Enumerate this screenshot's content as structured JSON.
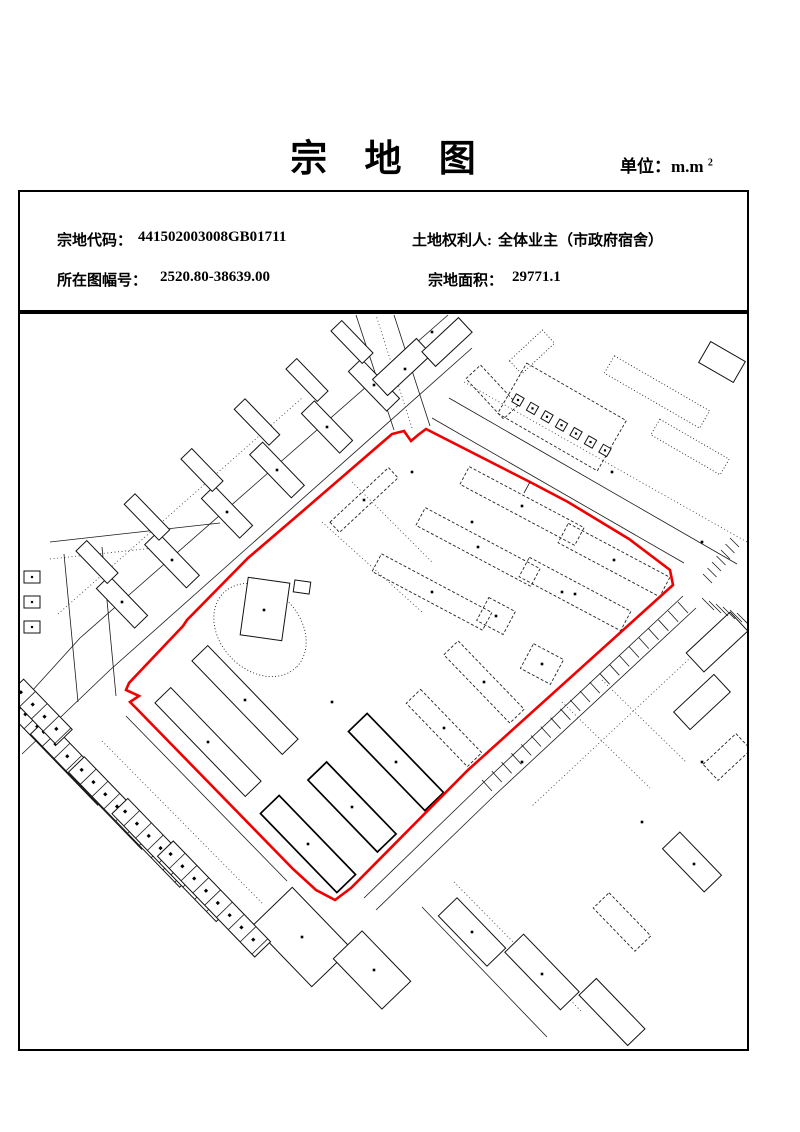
{
  "page": {
    "title": "宗 地 图",
    "unit_label": "单位：m.m",
    "unit_sup": "2"
  },
  "info": {
    "parcel_code_label": "宗地代码：",
    "parcel_code": "441502003008GB01711",
    "sheet_label": "所在图幅号：",
    "sheet_no": "2520.80-38639.00",
    "owner_label": "土地权利人: ",
    "owner": "全体业主（市政府宿舍）",
    "area_label": "宗地面积：",
    "area": "29771.1"
  },
  "map": {
    "north_label": "北",
    "boundary_color": "#f00000",
    "point_label_color": "#ff0000",
    "building_number_color": "#0008ff",
    "boundary_points": [
      {
        "name": "J1",
        "x": 409,
        "y": 439,
        "lx": 411,
        "ly": 451
      },
      {
        "name": "J2",
        "x": 416,
        "y": 433,
        "lx": 422,
        "ly": 439
      },
      {
        "name": "J3",
        "x": 424,
        "y": 427,
        "lx": 430,
        "ly": 422
      },
      {
        "name": "J4",
        "x": 528,
        "y": 480,
        "lx": 532,
        "ly": 473
      },
      {
        "name": "J5",
        "x": 566,
        "y": 500,
        "lx": 567,
        "ly": 493
      },
      {
        "name": "J6",
        "x": 627,
        "y": 537,
        "lx": 627,
        "ly": 530
      },
      {
        "name": "J7",
        "x": 668,
        "y": 568,
        "lx": 679,
        "ly": 566
      },
      {
        "name": "J8",
        "x": 671,
        "y": 583,
        "lx": 682,
        "ly": 586
      },
      {
        "name": "J9",
        "x": 466,
        "y": 768,
        "lx": 476,
        "ly": 779
      },
      {
        "name": "J10",
        "x": 349,
        "y": 886,
        "lx": 360,
        "ly": 886
      },
      {
        "name": "J11",
        "x": 333,
        "y": 898,
        "lx": 340,
        "ly": 909
      },
      {
        "name": "J12",
        "x": 314,
        "y": 888,
        "lx": 310,
        "ly": 898
      },
      {
        "name": "J13",
        "x": 291,
        "y": 867,
        "lx": 278,
        "ly": 864
      },
      {
        "name": "J14",
        "x": 134,
        "y": 706,
        "lx": 127,
        "ly": 719
      },
      {
        "name": "J15",
        "x": 128,
        "y": 700,
        "lx": 116,
        "ly": 706
      },
      {
        "name": "J16",
        "x": 137,
        "y": 694,
        "lx": 145,
        "ly": 699
      },
      {
        "name": "J17",
        "x": 124,
        "y": 688,
        "lx": 110,
        "ly": 691
      },
      {
        "name": "J18",
        "x": 127,
        "y": 681,
        "lx": 119,
        "ly": 681
      },
      {
        "name": "J19",
        "x": 181,
        "y": 624,
        "lx": 175,
        "ly": 626
      },
      {
        "name": "J20",
        "x": 185,
        "y": 618,
        "lx": 182,
        "ly": 614
      },
      {
        "name": "J21",
        "x": 246,
        "y": 556,
        "lx": 242,
        "ly": 555
      },
      {
        "name": "J22",
        "x": 295,
        "y": 514,
        "lx": 292,
        "ly": 512
      },
      {
        "name": "J23",
        "x": 390,
        "y": 432,
        "lx": 380,
        "ly": 427
      },
      {
        "name": "J24",
        "x": 402,
        "y": 429,
        "lx": 401,
        "ly": 422
      }
    ],
    "edge_lengths": [
      {
        "label": "58.24",
        "x": 474,
        "y": 452,
        "rot": 27
      },
      {
        "label": "33.80",
        "x": 597,
        "y": 515,
        "rot": 32
      },
      {
        "label": "25.88",
        "x": 648,
        "y": 549,
        "rot": 37
      },
      {
        "label": "131.90",
        "x": 573,
        "y": 674,
        "rot": -42
      },
      {
        "label": "78.50",
        "x": 407,
        "y": 823,
        "rot": -45
      },
      {
        "label": "21.67",
        "x": 296,
        "y": 873,
        "rot": 40
      },
      {
        "label": "99.25",
        "x": 203,
        "y": 785,
        "rot": 46
      },
      {
        "label": "40.50",
        "x": 146,
        "y": 648,
        "rot": -45
      },
      {
        "label": "41.36",
        "x": 208,
        "y": 590,
        "rot": -44
      },
      {
        "label": "32.07",
        "x": 266,
        "y": 537,
        "rot": -41
      },
      {
        "label": "61.84",
        "x": 339,
        "y": 468,
        "rot": -40
      }
    ],
    "building_numbers": [
      {
        "label": "1",
        "x": 587,
        "y": 545
      },
      {
        "label": "2",
        "x": 545,
        "y": 577
      },
      {
        "label": "3",
        "x": 534,
        "y": 655
      },
      {
        "label": "4",
        "x": 490,
        "y": 608
      },
      {
        "label": "5",
        "x": 465,
        "y": 667
      },
      {
        "label": "6",
        "x": 426,
        "y": 714
      },
      {
        "label": "8",
        "x": 379,
        "y": 751
      },
      {
        "label": "9",
        "x": 339,
        "y": 794
      },
      {
        "label": "10",
        "x": 295,
        "y": 828
      },
      {
        "label": "11",
        "x": 493,
        "y": 490
      },
      {
        "label": "12",
        "x": 449,
        "y": 529
      },
      {
        "label": "13",
        "x": 399,
        "y": 574
      },
      {
        "label": "14",
        "x": 232,
        "y": 689
      },
      {
        "label": "15",
        "x": 197,
        "y": 730
      },
      {
        "label": "16",
        "x": 348,
        "y": 486
      }
    ],
    "micro_texts": [
      {
        "text": "（人民····）",
        "x": 573,
        "y": 758,
        "rot": 0,
        "color": "#000"
      },
      {
        "text": "·······",
        "x": 141,
        "y": 663,
        "rot": -43,
        "color": "#0008ff"
      }
    ]
  }
}
